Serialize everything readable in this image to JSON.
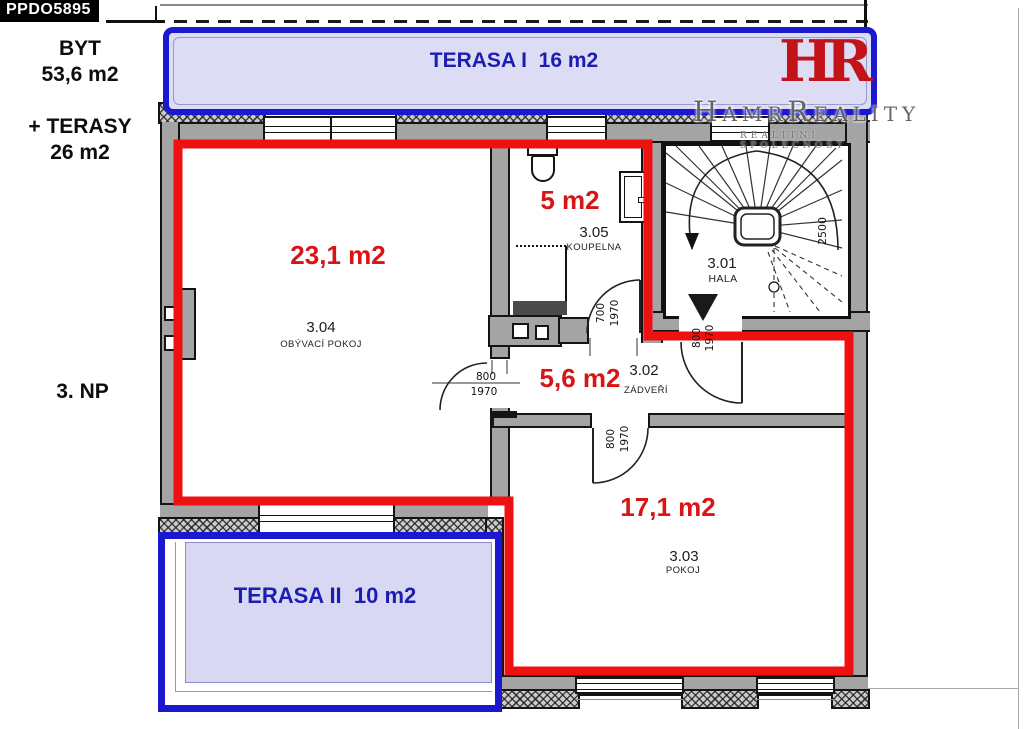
{
  "badge": "PPDO5895",
  "sidebar": {
    "byt_label": "BYT",
    "byt_area": "53,6 m2",
    "terasy_label": "+ TERASY",
    "terasy_area": "26 m2",
    "floor": "3. NP"
  },
  "terrace1": {
    "label": "TERASA I  16 m2"
  },
  "terrace2": {
    "label": "TERASA II  10 m2"
  },
  "logo": {
    "monogram": "HR",
    "name": "HamrReality",
    "subtitle": "REALITNÍ SPOLEČNOST"
  },
  "rooms": {
    "livingroom": {
      "area": "23,1 m2",
      "number": "3.04",
      "name": "OBÝVACÍ POKOJ"
    },
    "bathroom": {
      "area": "5 m2",
      "number": "3.05",
      "name": "KOUPELNA"
    },
    "hall": {
      "number": "3.01",
      "name": "HALA"
    },
    "vestibule": {
      "area": "5,6 m2",
      "number": "3.02",
      "name": "ZÁDVEŘÍ"
    },
    "room": {
      "area": "17,1 m2",
      "number": "3.03",
      "name": "POKOJ"
    }
  },
  "dims": {
    "bath_w": "700",
    "bath_h": "1970",
    "lr_w": "800",
    "lr_h": "1970",
    "entry_w": "800",
    "entry_h": "1970",
    "room_w": "800",
    "room_h": "1970",
    "stair": "2500"
  },
  "colors": {
    "outline_red": "#ee1111",
    "terrace_blue": "#1b18cf",
    "area_red": "#d91414",
    "wall_grey": "#a4a4a4"
  }
}
